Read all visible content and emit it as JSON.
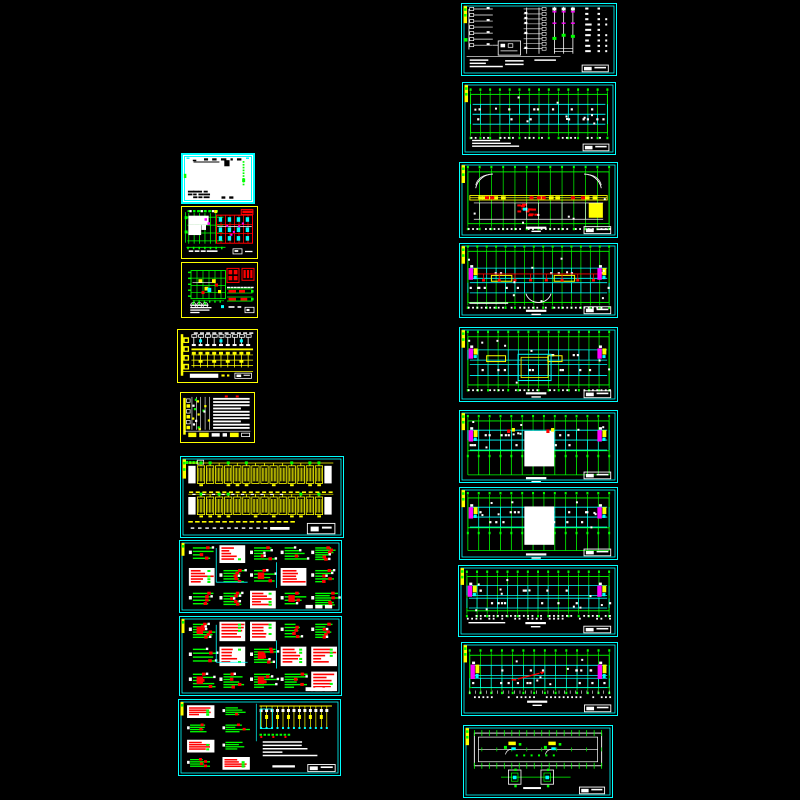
{
  "document": {
    "type": "cad-drawing-set-preview",
    "sheet_count": 19,
    "columns": 2,
    "background": "#000000"
  },
  "canvas": {
    "width": 800,
    "height": 800
  },
  "palette": {
    "black": "#000000",
    "white": "#ffffff",
    "cyan": "#00ffff",
    "yellow": "#ffff00",
    "green": "#00ff00",
    "red": "#ff0000",
    "magenta": "#ff00ff"
  },
  "sheets": [
    {
      "id": "L1",
      "label": "cover-sheet",
      "x": 181,
      "y": 153,
      "w": 74,
      "h": 51,
      "border": "#00ffff",
      "bw": 2,
      "bg": "#ffffff",
      "kind": "cover",
      "seed": 11
    },
    {
      "id": "L2",
      "label": "substation-room-plan",
      "x": 181,
      "y": 206,
      "w": 77,
      "h": 53,
      "border": "#ffff00",
      "bw": 1,
      "bg": "#000000",
      "kind": "planA",
      "seed": 22
    },
    {
      "id": "L3",
      "label": "equipment-layout-plan",
      "x": 181,
      "y": 262,
      "w": 77,
      "h": 56,
      "border": "#ffff00",
      "bw": 1,
      "bg": "#000000",
      "kind": "planB",
      "seed": 33
    },
    {
      "id": "L4",
      "label": "main-wiring-diagram",
      "x": 177,
      "y": 329,
      "w": 81,
      "h": 54,
      "border": "#ffff00",
      "bw": 1,
      "bg": "#000000",
      "kind": "busbar",
      "seed": 44
    },
    {
      "id": "L5",
      "label": "equipment-schedule",
      "x": 180,
      "y": 392,
      "w": 75,
      "h": 51,
      "border": "#ffff00",
      "bw": 1,
      "bg": "#000000",
      "kind": "table",
      "seed": 55
    },
    {
      "id": "L6",
      "label": "distribution-system-diagram-1",
      "x": 180,
      "y": 456,
      "w": 164,
      "h": 82,
      "border": "#00ffff",
      "bw": 1,
      "bg": "#000000",
      "kind": "dist",
      "seed": 66
    },
    {
      "id": "L7",
      "label": "distribution-system-diagram-2",
      "x": 179,
      "y": 540,
      "w": 163,
      "h": 73,
      "border": "#00ffff",
      "bw": 1,
      "bg": "#000000",
      "kind": "schem",
      "seed": 77,
      "opts": {
        "whiteBg": 0.12
      }
    },
    {
      "id": "L8",
      "label": "distribution-system-diagram-3",
      "x": 179,
      "y": 616,
      "w": 163,
      "h": 80,
      "border": "#00ffff",
      "bw": 1,
      "bg": "#000000",
      "kind": "schem",
      "seed": 88,
      "opts": {
        "whiteBg": 0.45
      }
    },
    {
      "id": "L9",
      "label": "distribution-system-diagram-4",
      "x": 178,
      "y": 699,
      "w": 163,
      "h": 77,
      "border": "#00ffff",
      "bw": 1,
      "bg": "#000000",
      "kind": "mixed",
      "seed": 99
    },
    {
      "id": "R1",
      "label": "riser-system-diagram",
      "x": 461,
      "y": 3,
      "w": 156,
      "h": 73,
      "border": "#00ffff",
      "bw": 1,
      "bg": "#000000",
      "kind": "system",
      "seed": 101
    },
    {
      "id": "R2",
      "label": "basement-grid-plan",
      "x": 462,
      "y": 82,
      "w": 154,
      "h": 73,
      "border": "#00ffff",
      "bw": 1,
      "bg": "#000000",
      "kind": "plan",
      "seed": 102,
      "opts": {
        "cols": 15,
        "top": 0.16,
        "bot": 0.7,
        "cyanBands": [
          [
            0.3,
            0.44
          ],
          [
            0.44,
            0.58
          ]
        ],
        "dims": [
          0.76
        ],
        "notes": 3
      }
    },
    {
      "id": "R3",
      "label": "ground-floor-plan",
      "x": 459,
      "y": 162,
      "w": 159,
      "h": 76,
      "border": "#00ffff",
      "bw": 1,
      "bg": "#000000",
      "kind": "plan",
      "seed": 103,
      "opts": {
        "cols": 13,
        "top": 0.12,
        "bot": 0.82,
        "arcs": "topcorners",
        "band": [
          0.44,
          0.06
        ],
        "yellowRect": [
          0.82,
          0.54,
          0.09,
          0.2
        ],
        "redCluster": [
          0.34,
          0.54,
          0.2,
          0.16
        ],
        "whiteWalls": [
          0.54,
          0.76
        ],
        "dims": [
          0.88
        ],
        "titleBar": 0.86
      }
    },
    {
      "id": "R4",
      "label": "first-floor-plan",
      "x": 459,
      "y": 243,
      "w": 159,
      "h": 75,
      "border": "#00ffff",
      "bw": 1,
      "bg": "#000000",
      "kind": "plan",
      "seed": 104,
      "opts": {
        "cols": 16,
        "top": 0.1,
        "bot": 0.8,
        "cyanBands": [
          [
            0.33,
            0.47
          ],
          [
            0.53,
            0.67
          ]
        ],
        "redRun": 0.41,
        "yellowRects": [
          [
            0.2,
            0.43,
            0.13,
            0.08
          ],
          [
            0.6,
            0.43,
            0.13,
            0.08
          ]
        ],
        "ends": [
          0.33,
          0.49
        ],
        "arcs": "bottomcenter",
        "dims": [
          0.86
        ],
        "titleBar": 0.9,
        "notes": 1
      }
    },
    {
      "id": "R5",
      "label": "second-floor-plan",
      "x": 459,
      "y": 327,
      "w": 159,
      "h": 75,
      "border": "#00ffff",
      "bw": 1,
      "bg": "#000000",
      "kind": "plan",
      "seed": 105,
      "opts": {
        "cols": 15,
        "top": 0.12,
        "bot": 0.78,
        "cyanBands": [
          [
            0.3,
            0.44
          ],
          [
            0.5,
            0.65
          ]
        ],
        "yellowRects": [
          [
            0.17,
            0.38,
            0.12,
            0.08
          ],
          [
            0.56,
            0.38,
            0.09,
            0.08
          ]
        ],
        "center": [
          "outline",
          0.37,
          0.36,
          0.21,
          0.36
        ],
        "ends": [
          0.28,
          0.42
        ],
        "dims": [
          0.84
        ],
        "titleBar": 0.88
      }
    },
    {
      "id": "R6",
      "label": "third-floor-plan",
      "x": 459,
      "y": 410,
      "w": 159,
      "h": 73,
      "border": "#00ffff",
      "bw": 1,
      "bg": "#000000",
      "kind": "plan",
      "seed": 106,
      "opts": {
        "cols": 14,
        "top": 0.14,
        "bot": 0.56,
        "cyanBands": [
          [
            0.27,
            0.41
          ],
          [
            0.41,
            0.55
          ]
        ],
        "center": [
          "white",
          0.41,
          0.28,
          0.19,
          0.5
        ],
        "legs": [
          0.56,
          0.9
        ],
        "ends": [
          0.27,
          0.43
        ],
        "midAccents": true,
        "titleBar": 0.93
      }
    },
    {
      "id": "R7",
      "label": "fourth-floor-plan",
      "x": 459,
      "y": 487,
      "w": 159,
      "h": 73,
      "border": "#00ffff",
      "bw": 1,
      "bg": "#000000",
      "kind": "plan",
      "seed": 107,
      "opts": {
        "cols": 14,
        "top": 0.14,
        "bot": 0.56,
        "cyanBands": [
          [
            0.27,
            0.41
          ],
          [
            0.41,
            0.55
          ]
        ],
        "center": [
          "white",
          0.41,
          0.26,
          0.19,
          0.54
        ],
        "legs": [
          0.56,
          0.88
        ],
        "ends": [
          0.27,
          0.43
        ],
        "titleBar": 0.92
      }
    },
    {
      "id": "R8",
      "label": "fifth-floor-plan",
      "x": 458,
      "y": 565,
      "w": 160,
      "h": 72,
      "border": "#00ffff",
      "bw": 1,
      "bg": "#000000",
      "kind": "plan",
      "seed": 108,
      "opts": {
        "cols": 15,
        "top": 0.15,
        "bot": 0.64,
        "cyanBands": [
          [
            0.28,
            0.42
          ],
          [
            0.46,
            0.6
          ]
        ],
        "ends": [
          0.28,
          0.44
        ],
        "dims": [
          0.7,
          0.74
        ],
        "titleBar": 0.8,
        "notes": 1
      }
    },
    {
      "id": "R9",
      "label": "sixth-floor-plan",
      "x": 461,
      "y": 642,
      "w": 157,
      "h": 74,
      "border": "#00ffff",
      "bw": 1,
      "bg": "#000000",
      "kind": "plan",
      "seed": 109,
      "opts": {
        "cols": 14,
        "top": 0.17,
        "bot": 0.62,
        "cyanBands": [
          [
            0.31,
            0.45
          ],
          [
            0.49,
            0.62
          ]
        ],
        "ends": [
          0.3,
          0.5
        ],
        "redArrow": true,
        "comb": 0.66,
        "dims": [
          0.74
        ],
        "titleBar": 0.8
      }
    },
    {
      "id": "R10",
      "label": "roof-plan",
      "x": 463,
      "y": 725,
      "w": 150,
      "h": 73,
      "border": "#00ffff",
      "bw": 1,
      "bg": "#000000",
      "kind": "roof",
      "seed": 110
    }
  ]
}
